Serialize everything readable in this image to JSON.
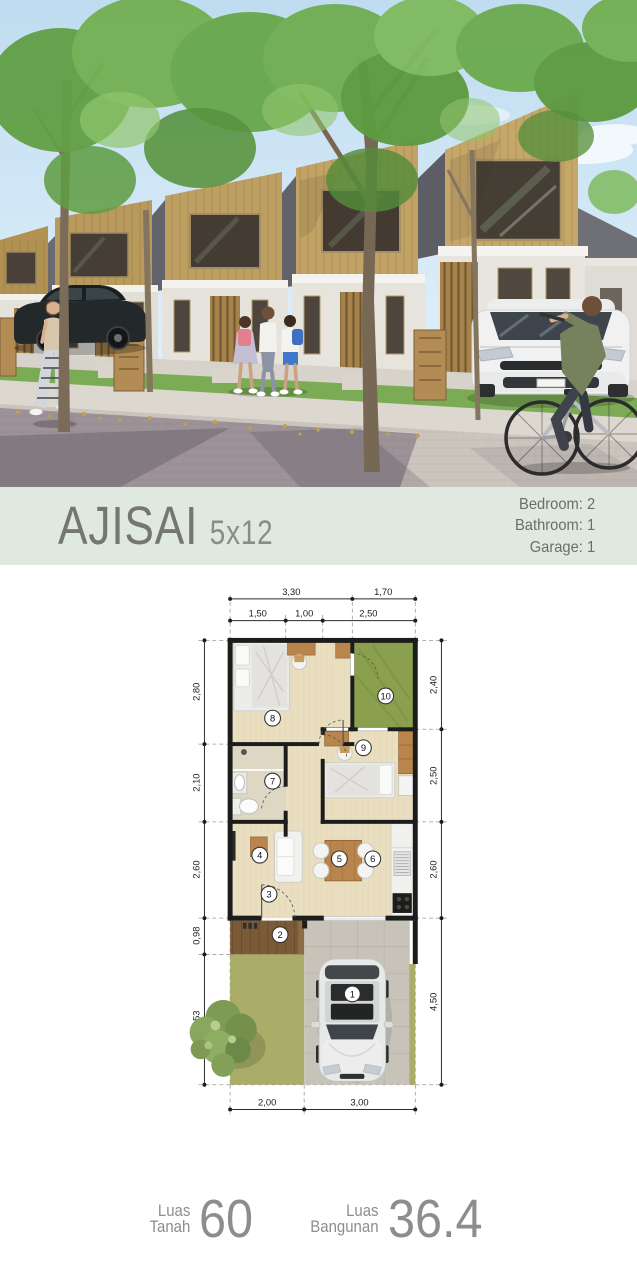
{
  "banner": {
    "title": "AJISAI",
    "size": "5x12",
    "specs": [
      "Bedroom: 2",
      "Bathroom: 1",
      "Garage: 1"
    ]
  },
  "plan": {
    "dims": {
      "top_outer": [
        "3,30",
        "1,70"
      ],
      "top_inner": [
        "1,50",
        "1,00",
        "2,50"
      ],
      "left": [
        "2,80",
        "2,10",
        "2,60",
        "0,98",
        "3,53"
      ],
      "right": [
        "2,40",
        "2,50",
        "2,60",
        "4,50"
      ],
      "bottom": [
        "2,00",
        "3,00"
      ]
    },
    "markers": [
      "1",
      "2",
      "3",
      "4",
      "5",
      "6",
      "7",
      "8",
      "9",
      "10"
    ]
  },
  "areas": {
    "land": {
      "label_line1": "Luas",
      "label_line2": "Tanah",
      "value": "60"
    },
    "building": {
      "label_line1": "Luas",
      "label_line2": "Bangunan",
      "value": "36.4"
    }
  },
  "colors": {
    "banner_bg": "#dfe9e0",
    "banner_text": "#75766f",
    "spec_text": "#667168",
    "plan_wall": "#1c1c1c",
    "plan_floor": "#e9debf",
    "plan_wood": "#b9854c",
    "plan_garden": "#8aa04e",
    "plan_yard": "#a9ad68",
    "plan_deck": "#7b5a37",
    "plan_paving": "#c7c3b9",
    "photo_sky": "#c8e0f1",
    "photo_facade_wood": "#c2a265",
    "photo_grass": "#7cab55",
    "photo_street": "#9c9298"
  }
}
